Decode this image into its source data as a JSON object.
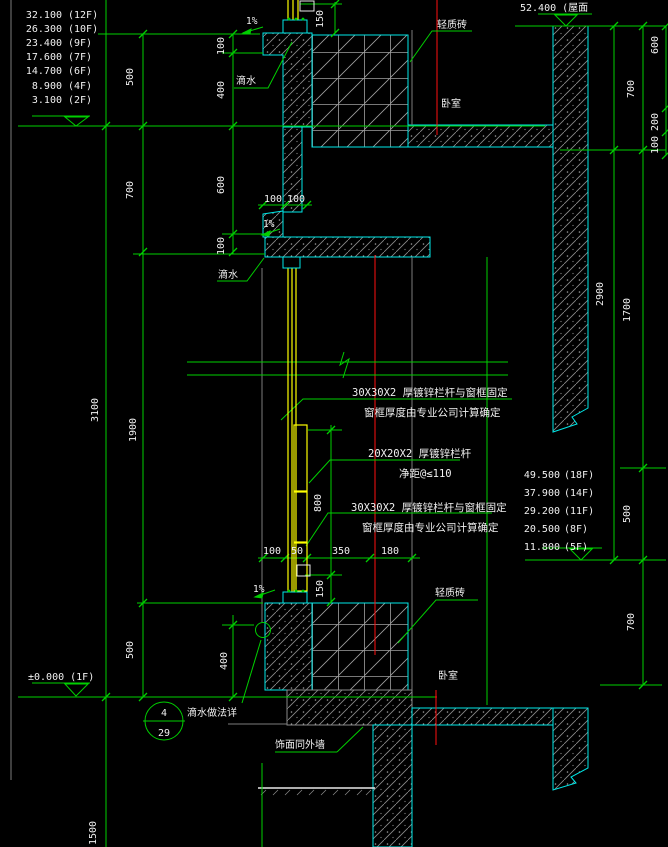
{
  "colors": {
    "background": "#000000",
    "drawing_green": "#00cf00",
    "wall_outline_cyan": "#00e8e8",
    "window_yellow": "#ffff00",
    "axis_red": "#ff0000",
    "hatch_gray": "#909090",
    "text_white": "#f0f0f0"
  },
  "left_levels": [
    {
      "value": "32.100",
      "floor": "(12F)"
    },
    {
      "value": "26.300",
      "floor": "(10F)"
    },
    {
      "value": "23.400",
      "floor": "(9F)"
    },
    {
      "value": "17.600",
      "floor": "(7F)"
    },
    {
      "value": "14.700",
      "floor": "(6F)"
    },
    {
      "value": "8.900",
      "floor": "(4F)"
    },
    {
      "value": "3.100",
      "floor": "(2F)"
    }
  ],
  "right_levels": [
    {
      "value": "49.500",
      "floor": "(18F)"
    },
    {
      "value": "37.900",
      "floor": "(14F)"
    },
    {
      "value": "29.200",
      "floor": "(11F)"
    },
    {
      "value": "20.500",
      "floor": "(8F)"
    },
    {
      "value": "11.800",
      "floor": "(5F)"
    }
  ],
  "roof_level": "52.400 (屋面",
  "ground_floor_level": "±0.000  (1F)",
  "rooms": {
    "bedroom_upper": "卧室",
    "bedroom_lower": "卧室"
  },
  "materials": {
    "light_brick_upper": "轻质砖",
    "light_brick_lower": "轻质砖",
    "finish_same_as_wall": "饰面同外墙"
  },
  "drips": {
    "drip_upper": "滴水",
    "drip_middle": "滴水",
    "drip_detail_note": "滴水做法详"
  },
  "slopes": {
    "upper": "1%",
    "middle": "1%",
    "lower": "1%"
  },
  "detail_callout": {
    "number": "4",
    "sheet": "29"
  },
  "annotations": {
    "railing_fix_top": {
      "line1": "30X30X2 厚镀锌栏杆与窗框固定",
      "line2": "窗框厚度由专业公司计算确定"
    },
    "railing_mid": {
      "line1": "20X20X2 厚镀锌栏杆",
      "line2": "净距@≤110"
    },
    "railing_fix_bottom": {
      "line1": "30X30X2 厚镀锌栏杆与窗框固定",
      "line2": "窗框厚度由专业公司计算确定"
    }
  },
  "dims": [
    {
      "text": "500"
    },
    {
      "text": "700"
    },
    {
      "text": "3100"
    },
    {
      "text": "1900"
    },
    {
      "text": "500"
    },
    {
      "text": "1500"
    },
    {
      "text": "100"
    },
    {
      "text": "400"
    },
    {
      "text": "600"
    },
    {
      "text": "100"
    },
    {
      "text": "400"
    },
    {
      "text": "150"
    },
    {
      "text": "100"
    },
    {
      "text": "100"
    },
    {
      "text": "800"
    },
    {
      "text": "150"
    },
    {
      "text": "100"
    },
    {
      "text": "50"
    },
    {
      "text": "350"
    },
    {
      "text": "180"
    },
    {
      "text": "2900"
    },
    {
      "text": "700"
    },
    {
      "text": "1700"
    },
    {
      "text": "500"
    },
    {
      "text": "700"
    },
    {
      "text": "600"
    },
    {
      "text": "200"
    },
    {
      "text": "100"
    }
  ]
}
